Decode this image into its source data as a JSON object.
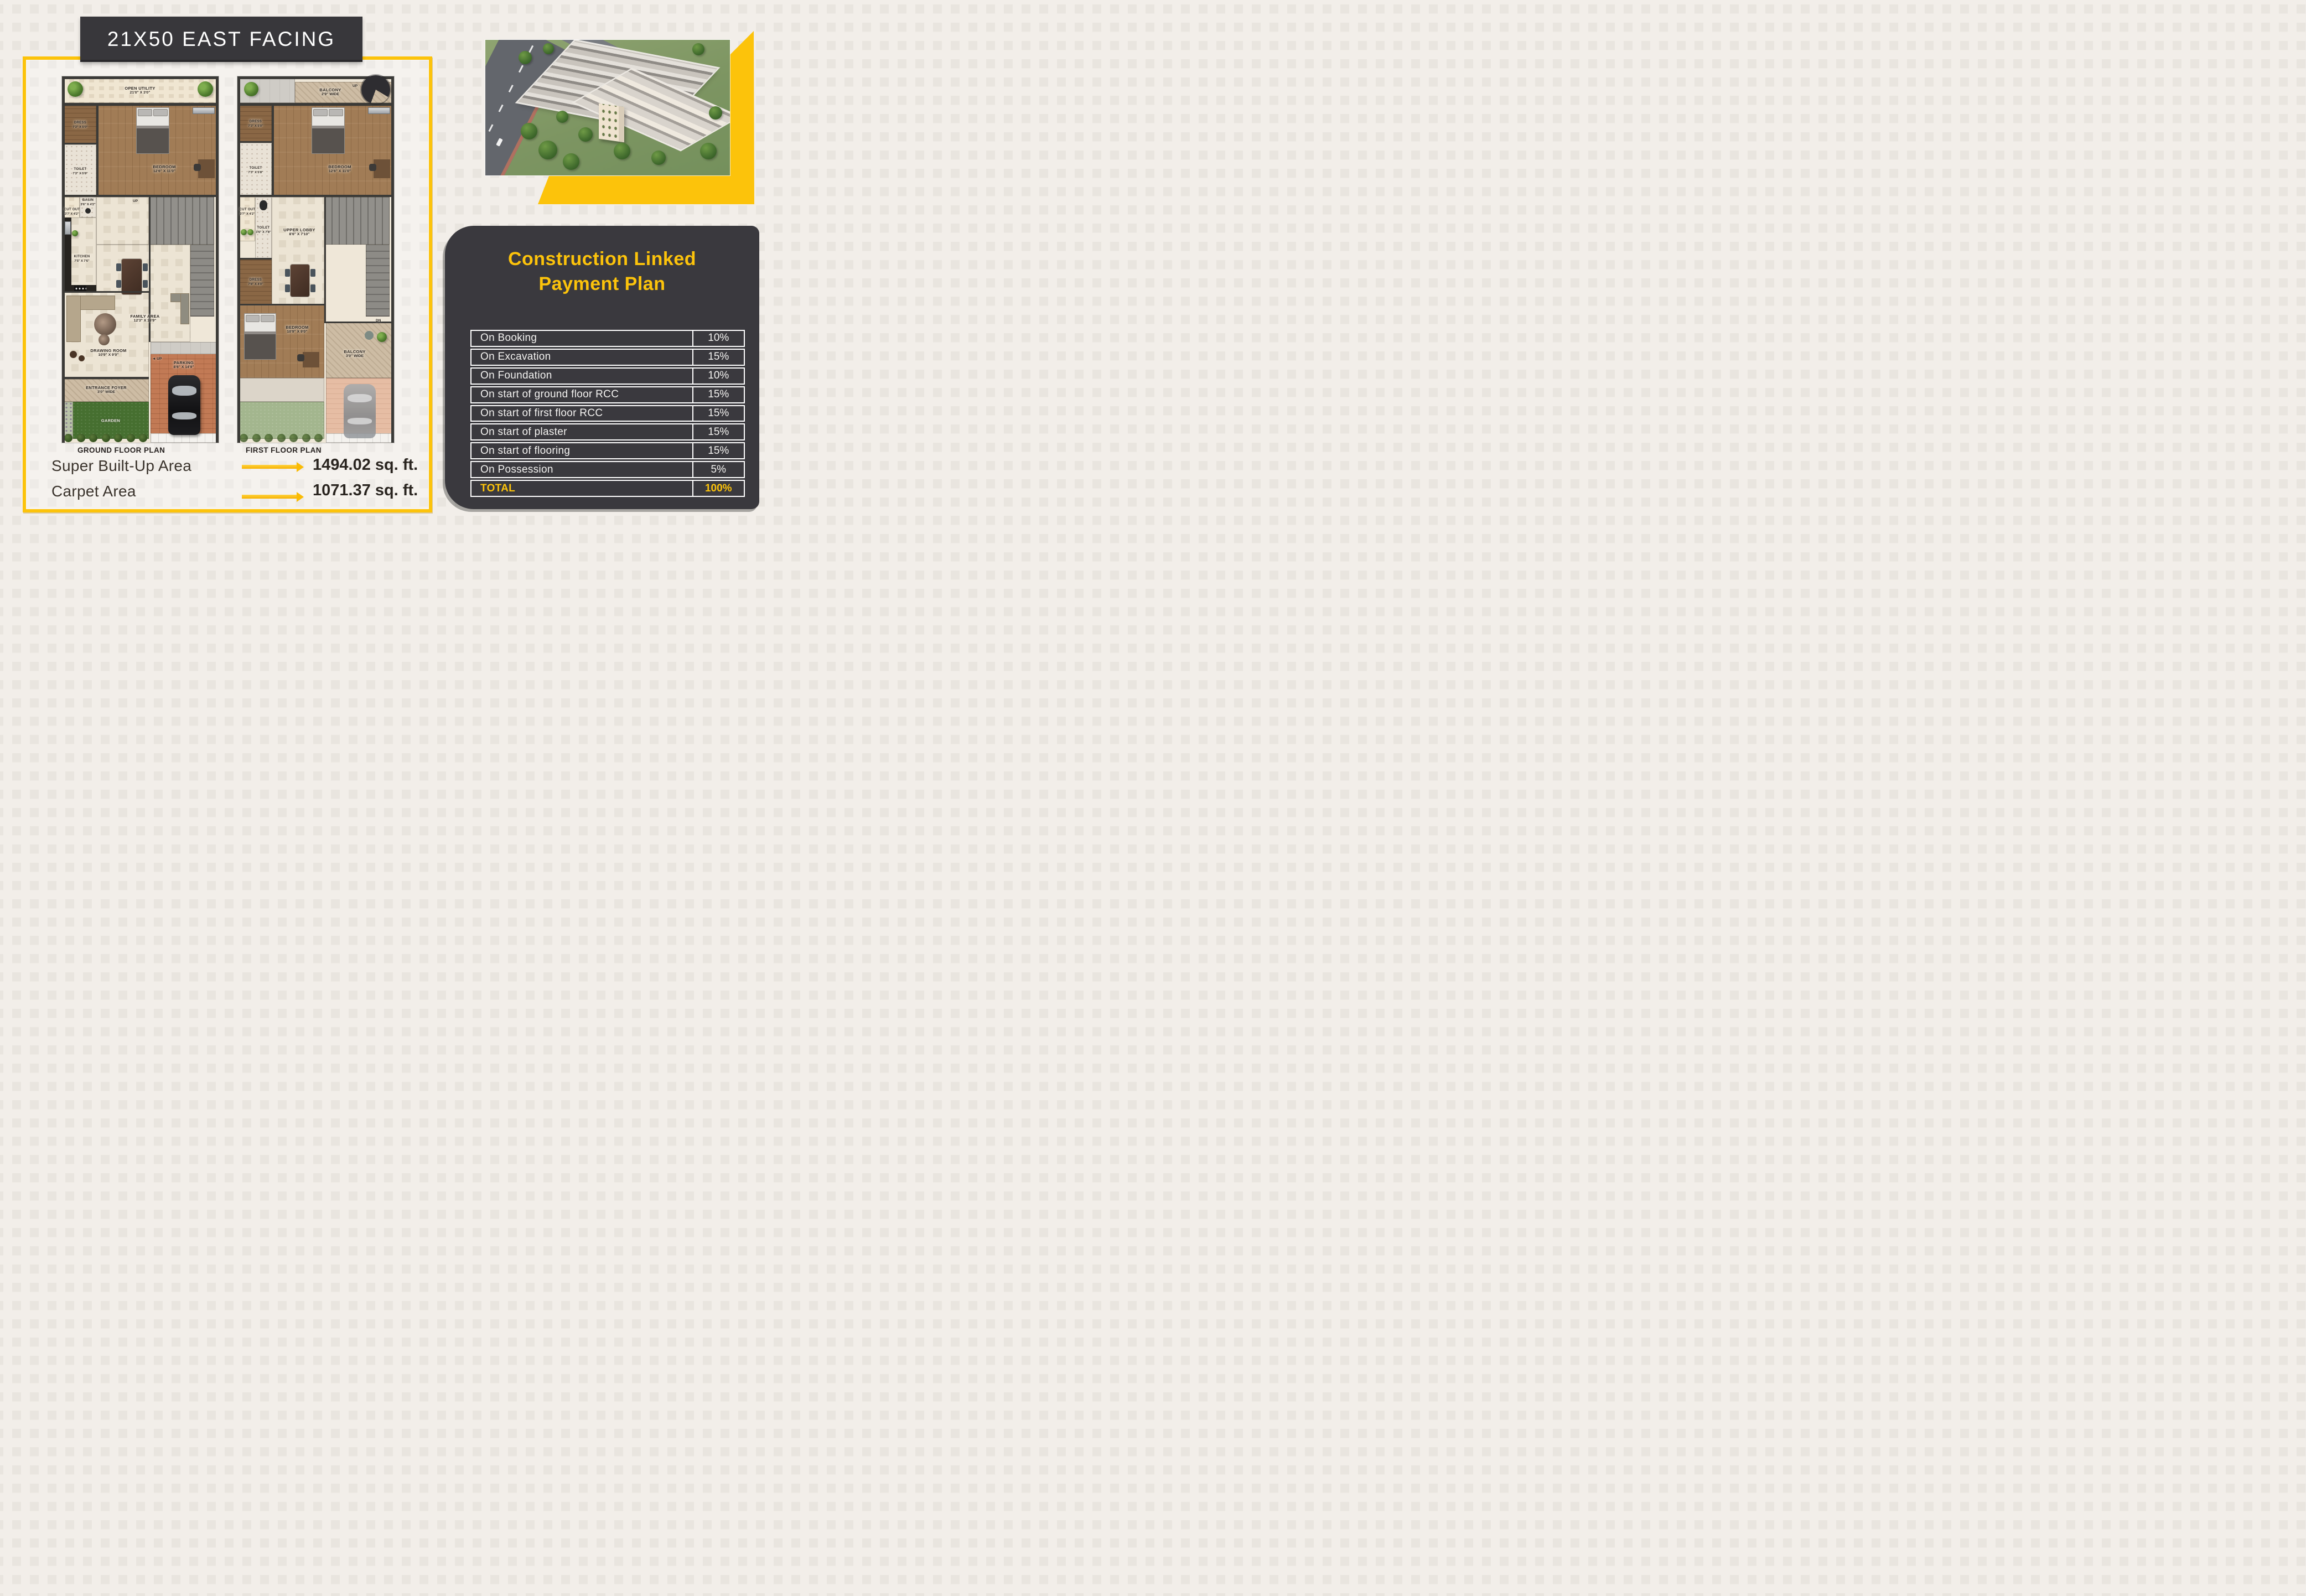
{
  "title_banner": {
    "text": "21X50 EAST FACING"
  },
  "colors": {
    "accent_yellow": "#FCC30B",
    "panel_dark": "#3A393E",
    "background_cream": "#F2EEE9",
    "wall_dark": "#3B3A37"
  },
  "hero": {
    "description": "aerial-3d-render-of-row-house-colony"
  },
  "plans": {
    "ground": {
      "caption": "GROUND FLOOR PLAN",
      "stairs_up_label": "UP",
      "parking_up_label": "UP",
      "rooms": {
        "open_utility": {
          "name": "OPEN UTILITY",
          "dims": "21'0\" X 3'0\""
        },
        "dress": {
          "name": "DRESS",
          "dims": "7'2\" X 5'0\""
        },
        "toilet": {
          "name": "TOILET",
          "dims": "7'2\" X 5'8\""
        },
        "bedroom": {
          "name": "BEDROOM",
          "dims": "12'6\" X 11'0\""
        },
        "cut_out": {
          "name": "CUT OUT",
          "dims": "3'7' X 4'2\""
        },
        "basin": {
          "name": "BASIN",
          "dims": "3'6\" X 4'2\""
        },
        "kitchen": {
          "name": "KITCHEN",
          "dims": "7'5\" X 7'6\""
        },
        "family_area": {
          "name": "FAMILY AREA",
          "dims": "12'3\" X 16'9\""
        },
        "drawing_room": {
          "name": "DRAWING ROOM",
          "dims": "10'9\" X 9'0\""
        },
        "entrance_foyer": {
          "name": "ENTRANCE FOYER",
          "dims": "3'0\" WIDE"
        },
        "garden": {
          "name": "GARDEN"
        },
        "parking": {
          "name": "PARKING",
          "dims": "8'6\" X 14'9\""
        }
      }
    },
    "first": {
      "caption": "FIRST FLOOR PLAN",
      "stairs_up_label": "UP",
      "stairs_dn_label": "DN",
      "rooms": {
        "balcony": {
          "name": "BALCONY",
          "dims": "2'9\" WIDE"
        },
        "dress": {
          "name": "DRESS",
          "dims": "7'3\" X 5'0\""
        },
        "toilet": {
          "name": "TOILET",
          "dims": "7'3\" X 5'8\""
        },
        "bedroom": {
          "name": "BEDROOM",
          "dims": "12'6\" X 11'0\""
        },
        "cut_out": {
          "name": "CUT OUT",
          "dims": "3'7\" X 4'2\""
        },
        "toilet2": {
          "name": "TOILET",
          "dims": "3'6\" X 7'8\""
        },
        "dress2": {
          "name": "DRESS",
          "dims": "7'8\" X 4'0\""
        },
        "upper_lobby": {
          "name": "UPPER LOBBY",
          "dims": "8'6\" X 7'10\""
        },
        "bedroom2": {
          "name": "BEDROOM",
          "dims": "10'9\" X 9'0\""
        },
        "balcony2": {
          "name": "BALCONY",
          "dims": "3'0\" WIDE"
        }
      }
    }
  },
  "areas": {
    "super_built_up_label": "Super Built-Up Area",
    "super_built_up_value": "1494.02 sq. ft.",
    "carpet_label": "Carpet Area",
    "carpet_value": "1071.37 sq. ft."
  },
  "payment_plan": {
    "title_line1": "Construction Linked",
    "title_line2": "Payment Plan",
    "rows": [
      {
        "label": "On Booking",
        "value": "10%"
      },
      {
        "label": "On Excavation",
        "value": "15%"
      },
      {
        "label": "On Foundation",
        "value": "10%"
      },
      {
        "label": "On start of ground floor RCC",
        "value": "15%"
      },
      {
        "label": "On start of first floor RCC",
        "value": "15%"
      },
      {
        "label": "On start of plaster",
        "value": "15%"
      },
      {
        "label": "On start of flooring",
        "value": "15%"
      },
      {
        "label": "On Possession",
        "value": "5%"
      }
    ],
    "total": {
      "label": "TOTAL",
      "value": "100%"
    }
  }
}
